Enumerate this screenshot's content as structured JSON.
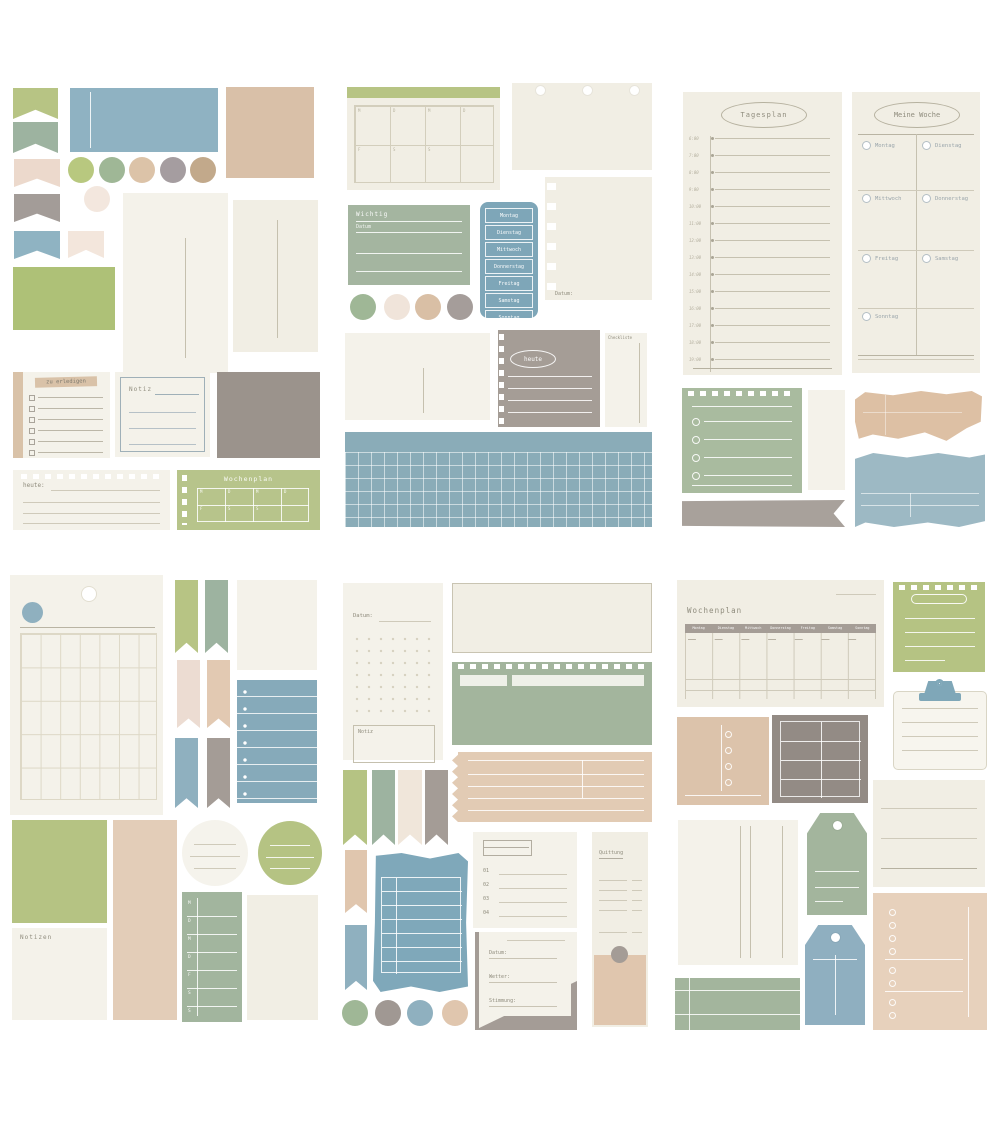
{
  "palette": {
    "green": "#b7c484",
    "green_grid": "#aec177",
    "sage": "#a3b59d",
    "blue": "#8fb1c1",
    "blue_deep": "#7ea6b8",
    "tan": "#ddc5ac",
    "brown": "#c3aa8d",
    "taupe": "#a39b94",
    "gray": "#a8a19b",
    "cream": "#f4f2ea",
    "blush": "#ecdfd4",
    "white": "#ffffff"
  },
  "days": [
    "Montag",
    "Dienstag",
    "Mittwoch",
    "Donnerstag",
    "Freitag",
    "Samstag",
    "Sonntag"
  ],
  "day_letters": [
    "M",
    "D",
    "M",
    "D",
    "F",
    "S",
    "S"
  ],
  "times": [
    "6:00",
    "7:00",
    "8:00",
    "9:00",
    "10:00",
    "11:00",
    "12:00",
    "13:00",
    "14:00",
    "15:00",
    "16:00",
    "17:00",
    "18:00",
    "19:00"
  ],
  "list_numbers": [
    "01",
    "02",
    "03",
    "04"
  ],
  "labels": {
    "tagesplan": "Tagesplan",
    "meine_woche": "Meine Woche",
    "wochenplan": "Wochenplan",
    "zu_erledigen": "zu erledigen",
    "notiz": "Notiz",
    "notizen": "Notizen",
    "wichtig": "Wichtig",
    "datum": "Datum",
    "datum_colon": "Datum:",
    "wetter_colon": "Wetter:",
    "stimmung_colon": "Stimmung:",
    "heute": "heute",
    "heute_colon": "heute:",
    "checkliste": "Checkliste",
    "quittung": "Quittung"
  }
}
